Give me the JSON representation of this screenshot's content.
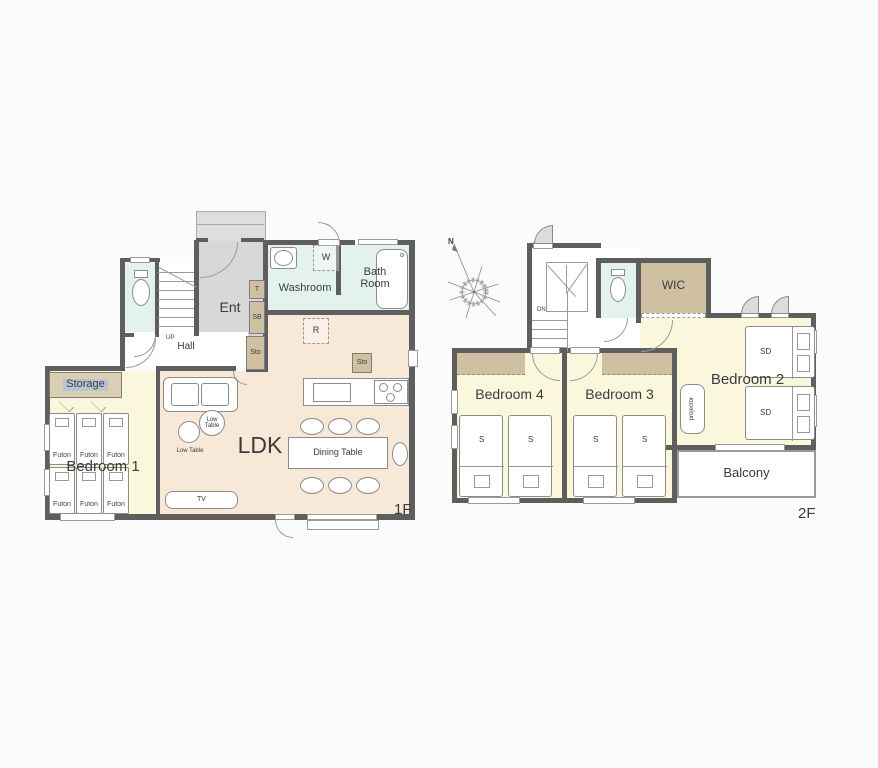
{
  "palette": {
    "wall": "#5e5e5e",
    "ldk_fill": "#f8e8d8",
    "bedroom_fill": "#fbf7dd",
    "wet_area_fill": "#e3f2ec",
    "closet_fill": "#cfc0a1",
    "storage_fill": "#dacfb2",
    "entrance_fill": "#d8d8d8",
    "porch_fill": "#dedede",
    "storage_label_highlight": "#b7c3d2",
    "text": "#3c3c3c"
  },
  "floor1": {
    "floor_label": "1F",
    "rooms": {
      "ent": "Ent",
      "hall": "Hall",
      "washroom": "Washroom",
      "bathroom": "Bath Room",
      "ldk": "LDK",
      "bedroom1": "Bedroom 1",
      "storage": "Storage"
    },
    "tags": {
      "toilet_tag": "T",
      "shoe_box": "SB",
      "storage_small": "Sto",
      "storage_kitchen": "Sto",
      "washer": "W",
      "refrigerator": "R",
      "stairs_up": "UP"
    },
    "furniture": {
      "futon": "Futon",
      "low_table": "Low Table",
      "dining_table": "Dining Table",
      "tv": "TV"
    }
  },
  "floor2": {
    "floor_label": "2F",
    "rooms": {
      "wic": "WIC",
      "bedroom2": "Bedroom 2",
      "bedroom3": "Bedroom 3",
      "bedroom4": "Bedroom 4",
      "balcony": "Balcony"
    },
    "tags": {
      "stairs_down": "DN",
      "north": "N",
      "projector": "projector",
      "single_bed": "S",
      "semi_double_bed": "SD"
    }
  }
}
